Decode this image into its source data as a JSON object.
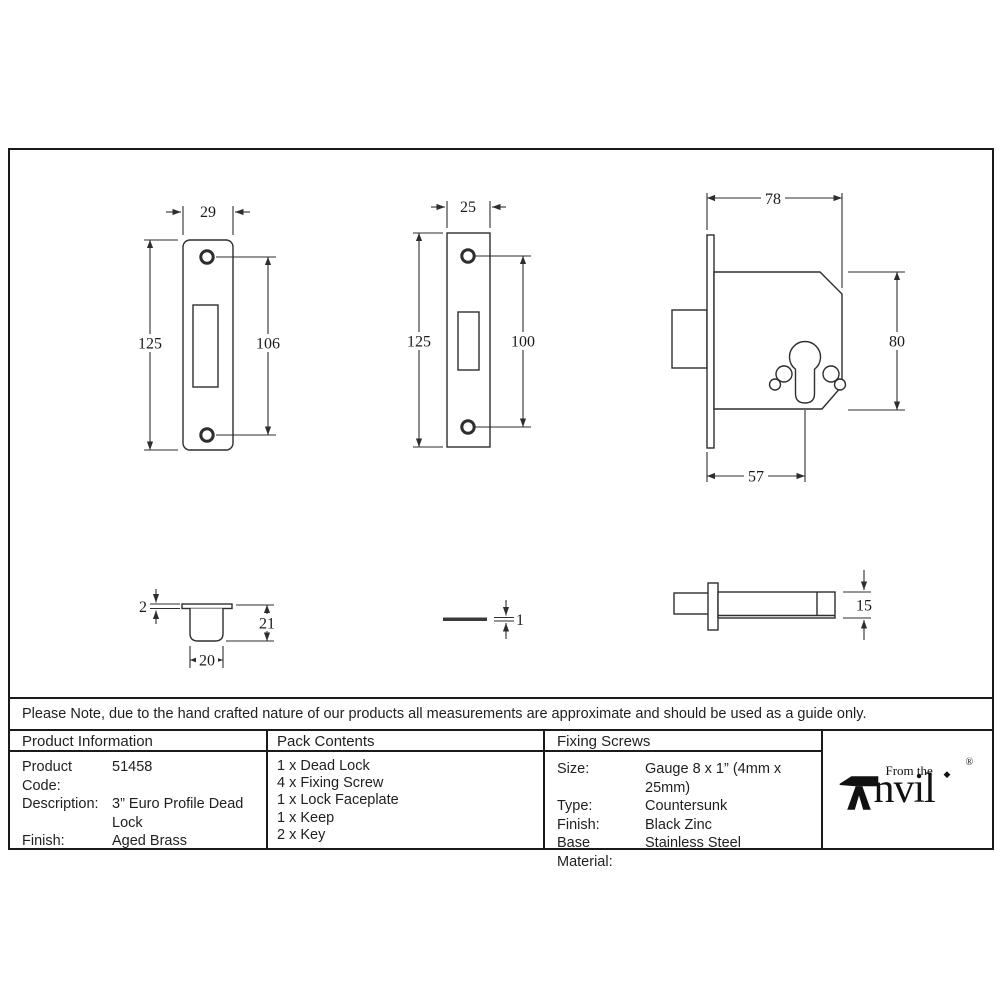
{
  "note": "Please Note, due to the hand crafted nature of our products all measurements are approximate and should be used as a guide only.",
  "product_information": {
    "header": "Product Information",
    "rows": [
      {
        "label": "Product Code:",
        "value": "51458"
      },
      {
        "label": "Description:",
        "value": "3” Euro Profile Dead Lock"
      },
      {
        "label": "Finish:",
        "value": "Aged Brass"
      }
    ]
  },
  "pack_contents": {
    "header": "Pack Contents",
    "items": [
      "1 x Dead Lock",
      "4 x Fixing Screw",
      "1 x Lock Faceplate",
      "1 x Keep",
      "2 x Key"
    ]
  },
  "fixing_screws": {
    "header": "Fixing Screws",
    "rows": [
      {
        "label": "Size:",
        "value": "Gauge 8 x 1” (4mm x 25mm)"
      },
      {
        "label": "Type:",
        "value": "Countersunk"
      },
      {
        "label": "Finish:",
        "value": "Black Zinc"
      },
      {
        "label": "Base Material:",
        "value": "Stainless Steel"
      }
    ]
  },
  "logo": {
    "prefix": "From the",
    "name_rest": "nvil",
    "tittle": "◆",
    "registered": "®"
  },
  "drawings": {
    "lock_faceplate_front": {
      "width": "29",
      "height": "125",
      "hole_spacing": "106"
    },
    "keep_faceplate_front": {
      "width": "25",
      "height": "125",
      "hole_spacing": "100"
    },
    "lock_body_front": {
      "width": "78",
      "height": "80",
      "backset": "57"
    },
    "keep_section": {
      "flange_thickness": "2",
      "depth": "21",
      "width": "20"
    },
    "faceplate_edge": {
      "thickness": "1"
    },
    "lock_body_top": {
      "thickness": "15"
    }
  }
}
